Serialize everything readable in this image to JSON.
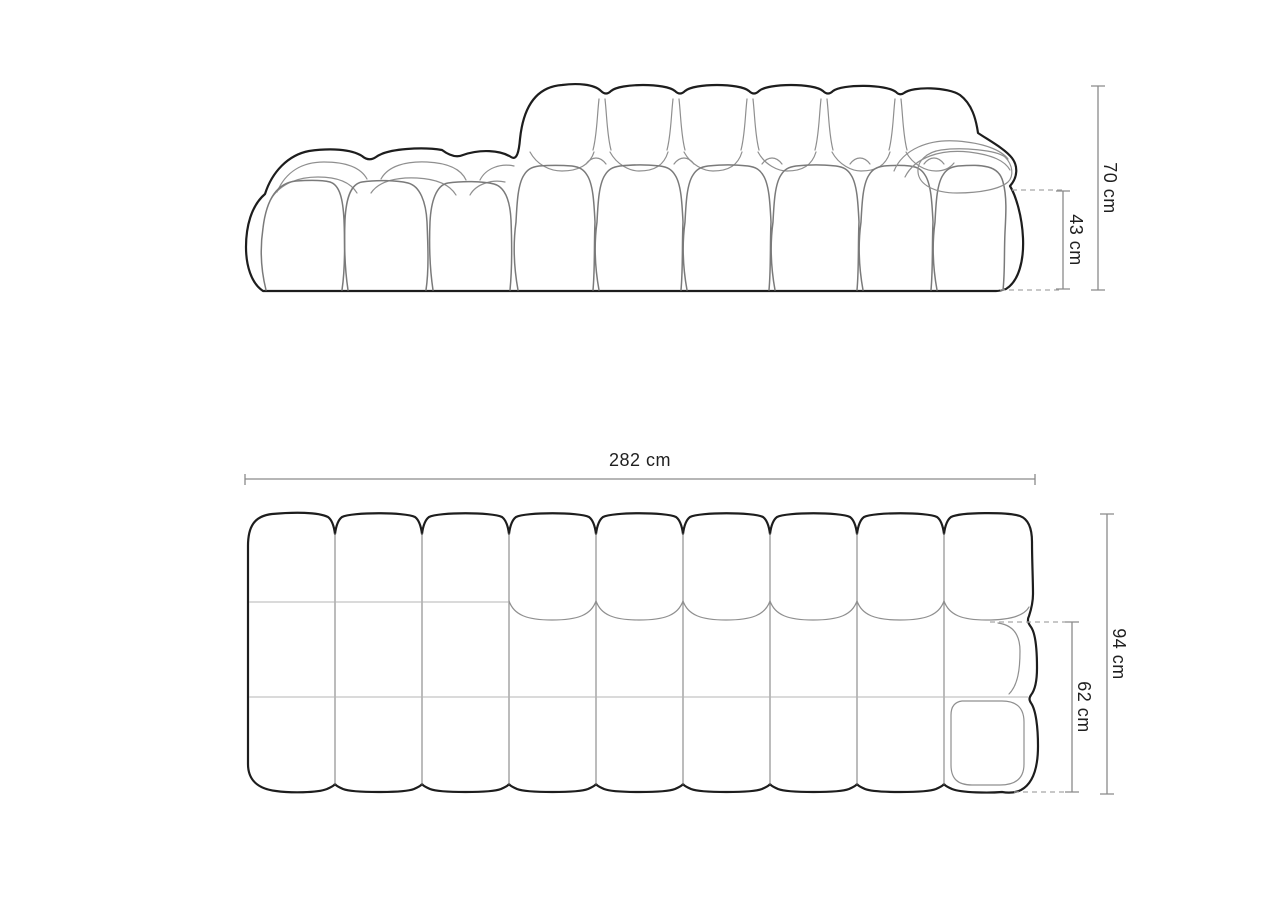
{
  "diagram": {
    "subject": "Modular bubble sofa technical dimension drawing with side elevation and top plan views",
    "views": [
      {
        "id": "elevation",
        "name": "side elevation"
      },
      {
        "id": "plan",
        "name": "top plan"
      }
    ],
    "labels": {
      "height_total": "70 cm",
      "height_seat": "43 cm",
      "width_total": "282 cm",
      "depth_total": "94 cm",
      "depth_seat": "62 cm"
    },
    "colors": {
      "outline": "#1d1d1d",
      "inner_line": "#8f8f8f",
      "light_line": "#b5b5b5",
      "dimension_line": "#8a8a8a",
      "dashed_line": "#a6a6a6",
      "label_text": "#1f1f1f",
      "background": "#ffffff"
    }
  }
}
